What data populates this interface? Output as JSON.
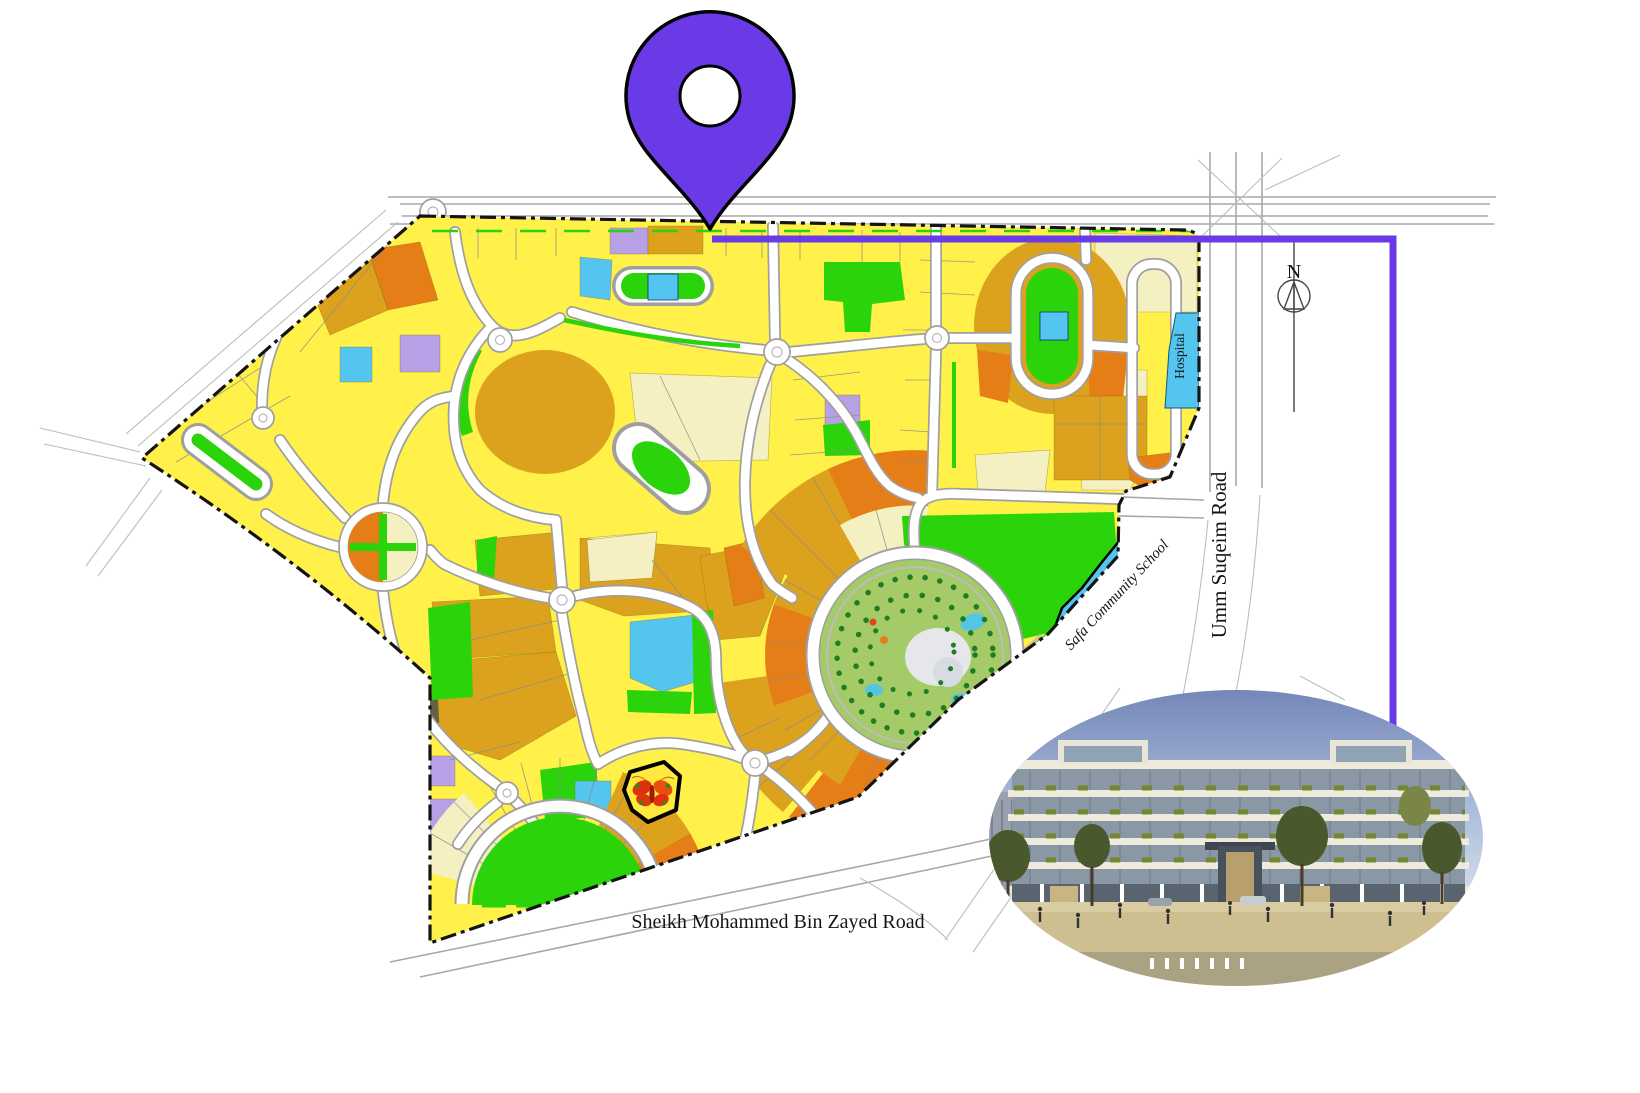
{
  "map": {
    "labels": {
      "hospital": "Hospital",
      "school": "Safa Community School",
      "umm_suqeim_road": "Umm Suqeim Road",
      "smbz_road": "Sheikh Mohammed Bin Zayed Road",
      "compass_north": "N"
    },
    "marker": {
      "shape": "location-pin",
      "color": "#6A3AE6"
    },
    "palette": {
      "residential_yellow": "#FFF04A",
      "residential_gold": "#DCA21D",
      "residential_orange": "#E67E17",
      "park_green": "#2BD30A",
      "community_blue": "#54C5EF",
      "utility_lavender": "#B7A0E6",
      "mixed_use_cream": "#F5F0C2",
      "desert_sand": "#D9BF93",
      "boundary_black": "#141414",
      "road_white": "#FFFFFF"
    },
    "inset": {
      "content": "residential-building-rendering"
    }
  }
}
